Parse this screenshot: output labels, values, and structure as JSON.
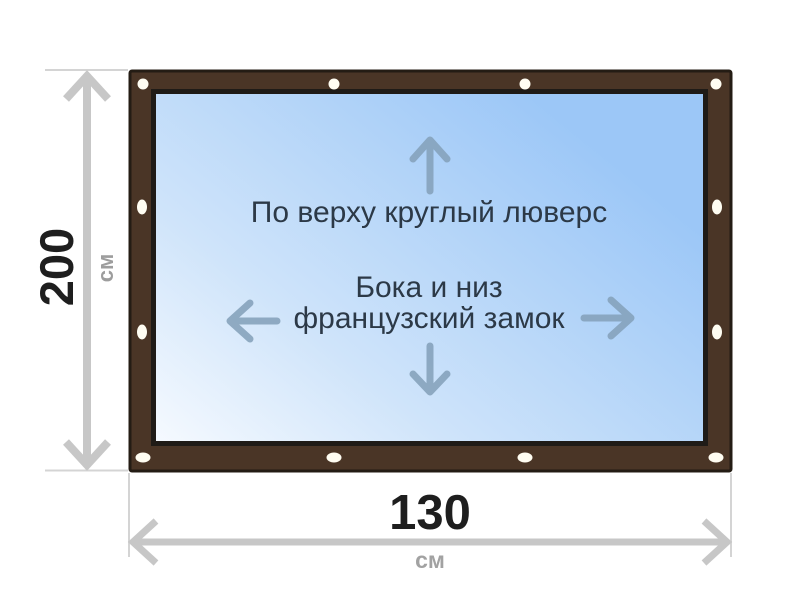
{
  "product_diagram": {
    "panel_notes": {
      "top": "По верху круглый люверс",
      "middle_line1": "Бока и низ",
      "middle_line2": "французский замок"
    },
    "height_dimension": {
      "value": "200",
      "unit": "см"
    },
    "width_dimension": {
      "value": "130",
      "unit": "см"
    },
    "grommets": {
      "count": 12,
      "color": "#fffdf2"
    },
    "icons": {
      "up": "up-arrow-icon",
      "down": "down-arrow-icon",
      "left": "left-arrow-icon",
      "right": "right-arrow-icon"
    },
    "colors": {
      "frame_brown": "#4a3526",
      "frame_outline": "#241c14",
      "panel_gradient_start": "#f6faff",
      "panel_gradient_mid": "#cfe4fa",
      "panel_gradient_end": "#9cc7f7",
      "dimension_line_gray": "#c7c7c7",
      "extension_line_gray": "#d4d4d4",
      "note_text": "#2c3947",
      "dimension_value_black": "#1e1e1e",
      "dimension_unit_gray": "#9d9d9d",
      "panel_arrow_slate": "#84a0ba"
    }
  }
}
